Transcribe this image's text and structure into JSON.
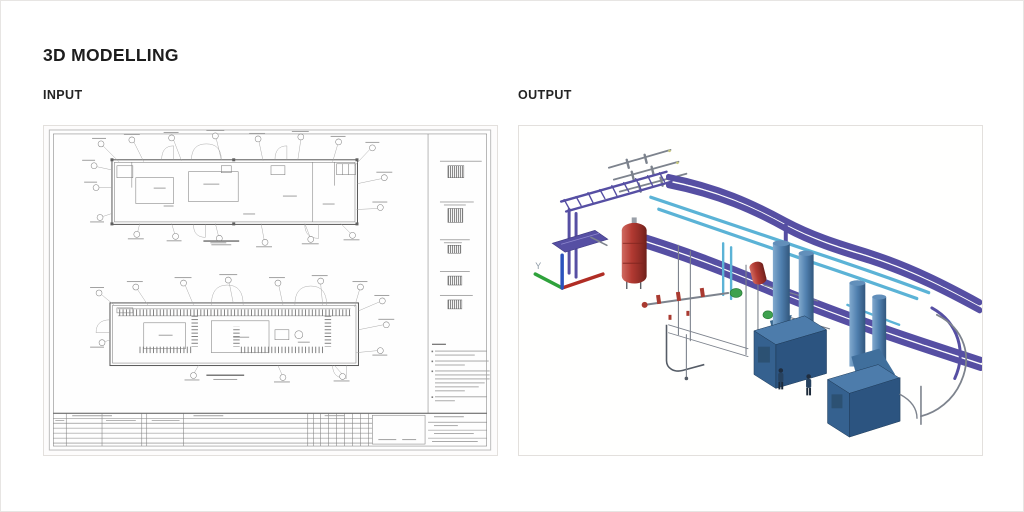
{
  "page": {
    "title": "3D MODELLING"
  },
  "panels": {
    "input": {
      "label": "INPUT"
    },
    "output": {
      "label": "OUTPUT",
      "axis_label_y": "Y"
    }
  },
  "colors": {
    "heading_text": "#1d1d1d",
    "label_text": "#242424",
    "page_border": "#e7e5e3",
    "panel_border": "#e3e0dd",
    "pipe_purple": "#564fa3",
    "pipe_purple_light": "#8e88cf",
    "pipe_cyan": "#5bb3d6",
    "pipe_cyan_light": "#bde6f4",
    "vessel_red": "#b23a32",
    "boiler_blue": "#35618f",
    "boiler_blue_top": "#4d7cab",
    "boiler_blue_dark": "#2c5480",
    "stack_blue": "#4f7fae",
    "machine_green": "#3fa14e",
    "steel_gray": "#7d838d",
    "axis_green": "#2fa23b",
    "axis_red": "#b02d24",
    "axis_blue": "#2a52bd"
  }
}
